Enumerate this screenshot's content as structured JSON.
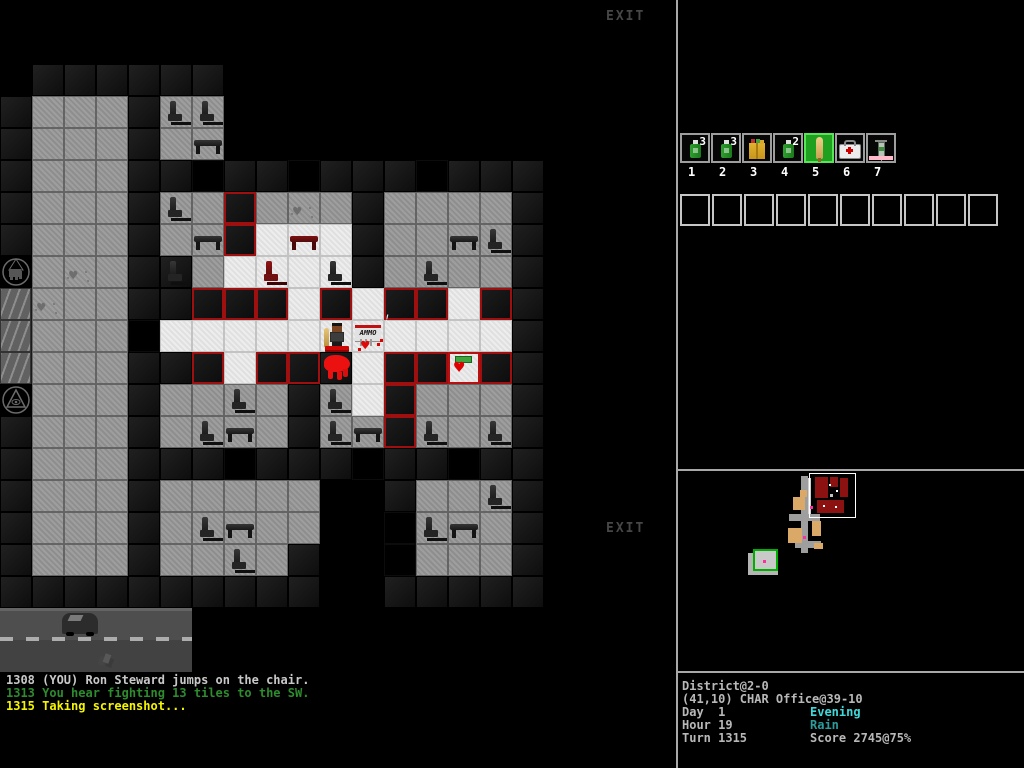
{
  "ui": {
    "exit_top": "EXIT",
    "exit_mid": "EXIT"
  },
  "character": {
    "title": "(YOU) Ron Steward, civilian"
  },
  "stats": {
    "rows": [
      {
        "label": "HP",
        "value": "12",
        "max": "15",
        "extra": "",
        "extra_color": "#ffffff",
        "fill": 0.8,
        "tick": null,
        "color": "#e60000"
      },
      {
        "label": "STA",
        "value": "33",
        "max": "35",
        "extra": "can run",
        "extra_color": "#22aa22",
        "fill": 0.94,
        "tick": 0.14,
        "color": "#1fa11f"
      },
      {
        "label": "FOO",
        "value": "919",
        "max": "1440",
        "extra": "6h",
        "extra_color": "#ffffff",
        "fill": 0.64,
        "tick": 0.51,
        "color": "#c0772c"
      },
      {
        "label": "SLP",
        "value": "1505",
        "max": "1800",
        "extra": "10h",
        "extra_color": "#ffffff",
        "fill": 0.84,
        "tick": 0.51,
        "color": "#2020dd"
      }
    ],
    "combat_lines": [
      "Melee  Atk 15   Dmg 10",
      "Ranged Atk 00   Dmg 00   Rng 0-0   Amo 0/0",
      "Def 12 Pro 0 Spd 1.00 FoV 5 Fol 0/0"
    ]
  },
  "inventory": {
    "header": "Inventory",
    "slots": [
      {
        "num": "1",
        "item": "bottle",
        "count": "3",
        "selected": false,
        "low_bar": false
      },
      {
        "num": "2",
        "item": "bottle",
        "count": "3",
        "selected": false,
        "low_bar": false
      },
      {
        "num": "3",
        "item": "bag",
        "count": "",
        "selected": false,
        "low_bar": false
      },
      {
        "num": "4",
        "item": "bottle",
        "count": "2",
        "selected": false,
        "low_bar": false
      },
      {
        "num": "5",
        "item": "bat",
        "count": "",
        "selected": true,
        "low_bar": false
      },
      {
        "num": "6",
        "item": "medkit",
        "count": "",
        "selected": false,
        "low_bar": false
      },
      {
        "num": "7",
        "item": "syringe",
        "count": "",
        "selected": false,
        "low_bar": true
      }
    ]
  },
  "ground": {
    "header": "Items on ground",
    "slot_count": 10
  },
  "skills": {
    "header": "Skills",
    "list": [
      "1-Agile",
      "1-Strong",
      "1-High Stamina"
    ]
  },
  "log": {
    "lines": [
      {
        "text": "1308 (YOU) Ron Steward jumps on the chair.",
        "color": "#c8c8c8"
      },
      {
        "text": "1313 You hear fighting 13 tiles to the SW.",
        "color": "#2e8b2e"
      },
      {
        "text": "1315 Taking screenshot...",
        "color": "#f5f500"
      }
    ]
  },
  "status": {
    "location": "District@2-0",
    "position": "(41,10) CHAR Office@39-10",
    "rows": [
      {
        "left": "Day  1",
        "right": "Evening",
        "right_color": "#3fd9d9"
      },
      {
        "left": "Hour 19",
        "right": "Rain",
        "right_color": "#2d9b9b"
      },
      {
        "left": "Turn 1315",
        "right": "Score 2745@75%",
        "right_color": "#b8b8b8"
      }
    ]
  },
  "map": {
    "ammo_label": "AMMO",
    "ammo_alert": "!!",
    "rows": [
      ".................",
      ".................",
      ".DDDDDD..........",
      "DGGGDGG..........",
      "DGGGDGG..........",
      "DGGGDDBDDBDDDBDDD",
      "DGGGDGGRGGGDGGGGD",
      "DGGGDGGRWWWDGGGGD",
      "1GGGDDGWWWWDGGGGD",
      "SGGGDDRRRWRWRRWRD",
      "SGGGBWWWWWWWWWWWD",
      "SGGGDDRWRRDWRRwRD",
      "2GGGDGGGGDGWRGGGD",
      "DGGGDGGGGDGGRGGGD",
      "DGGGDDDBDDDBDDBDD",
      "DGGGDGGGGG..DGGGD",
      "DGGGDGGGGG..BGGGD",
      "DGGGDGGGGD..BGGGD",
      "DDDDDDDDDD..DDDDD",
      "rrrrrr...........",
      "ssssss..........."
    ],
    "sprites": [
      {
        "type": "chair",
        "col": 5,
        "row": 3
      },
      {
        "type": "chair",
        "col": 6,
        "row": 3
      },
      {
        "type": "chair",
        "col": 5,
        "row": 6
      },
      {
        "type": "chair",
        "col": 5,
        "row": 8
      },
      {
        "type": "chair",
        "col": 15,
        "row": 7
      },
      {
        "type": "chair",
        "col": 13,
        "row": 8
      },
      {
        "type": "chair",
        "col": 10,
        "row": 8
      },
      {
        "type": "chair",
        "col": 7,
        "row": 12
      },
      {
        "type": "chair",
        "col": 10,
        "row": 12
      },
      {
        "type": "chair",
        "col": 6,
        "row": 13
      },
      {
        "type": "chair",
        "col": 10,
        "row": 13
      },
      {
        "type": "chair",
        "col": 13,
        "row": 13
      },
      {
        "type": "chair",
        "col": 15,
        "row": 13
      },
      {
        "type": "chair",
        "col": 15,
        "row": 15
      },
      {
        "type": "chair",
        "col": 6,
        "row": 16
      },
      {
        "type": "chair",
        "col": 13,
        "row": 16
      },
      {
        "type": "chair",
        "col": 7,
        "row": 17
      },
      {
        "type": "chair-red",
        "col": 8,
        "row": 8
      },
      {
        "type": "table",
        "col": 6,
        "row": 4
      },
      {
        "type": "table",
        "col": 6,
        "row": 7
      },
      {
        "type": "table",
        "col": 14,
        "row": 7
      },
      {
        "type": "table",
        "col": 7,
        "row": 13
      },
      {
        "type": "table",
        "col": 11,
        "row": 13
      },
      {
        "type": "table",
        "col": 7,
        "row": 16
      },
      {
        "type": "table",
        "col": 14,
        "row": 16
      },
      {
        "type": "table-red",
        "col": 9,
        "row": 7
      },
      {
        "type": "fluff",
        "col": 2,
        "row": 8
      },
      {
        "type": "fluff",
        "col": 1,
        "row": 9
      },
      {
        "type": "fluff",
        "col": 9,
        "row": 6
      },
      {
        "type": "blood",
        "col": 10,
        "row": 11
      },
      {
        "type": "heart-item",
        "col": 14,
        "row": 11
      },
      {
        "type": "player",
        "col": 10,
        "row": 10
      },
      {
        "type": "ammo-cart",
        "col": 11,
        "row": 10
      },
      {
        "type": "car",
        "x": 62,
        "y": 613
      },
      {
        "type": "debris",
        "x": 100,
        "y": 653
      },
      {
        "type": "road-dash",
        "x": 0,
        "y": 637
      }
    ]
  },
  "minimap": {
    "shapes": [
      {
        "x": 123,
        "y": 4,
        "w": 7,
        "h": 77,
        "fill": "#9e9e9e"
      },
      {
        "x": 111,
        "y": 42,
        "w": 31,
        "h": 7,
        "fill": "#9e9e9e"
      },
      {
        "x": 117,
        "y": 69,
        "w": 26,
        "h": 7,
        "fill": "#9e9e9e"
      },
      {
        "x": 130,
        "y": 6,
        "w": 3,
        "h": 36,
        "fill": "#cfcfcf"
      },
      {
        "x": 115,
        "y": 25,
        "w": 12,
        "h": 13,
        "fill": "#daa968"
      },
      {
        "x": 134,
        "y": 49,
        "w": 9,
        "h": 15,
        "fill": "#daa968"
      },
      {
        "x": 110,
        "y": 56,
        "w": 14,
        "h": 15,
        "fill": "#daa968"
      },
      {
        "x": 136,
        "y": 71,
        "w": 9,
        "h": 6,
        "fill": "#daa968"
      },
      {
        "x": 122,
        "y": 18,
        "w": 7,
        "h": 7,
        "fill": "#daa968"
      },
      {
        "x": 137,
        "y": 5,
        "w": 13,
        "h": 21,
        "fill": "#8c1212"
      },
      {
        "x": 152,
        "y": 5,
        "w": 8,
        "h": 10,
        "fill": "#8c1212"
      },
      {
        "x": 162,
        "y": 6,
        "w": 8,
        "h": 19,
        "fill": "#8c1212"
      },
      {
        "x": 139,
        "y": 28,
        "w": 27,
        "h": 13,
        "fill": "#8c1212"
      },
      {
        "x": 151,
        "y": 12,
        "w": 2,
        "h": 2,
        "fill": "#ffffff"
      },
      {
        "x": 158,
        "y": 18,
        "w": 2,
        "h": 2,
        "fill": "#ffffff"
      },
      {
        "x": 145,
        "y": 33,
        "w": 2,
        "h": 2,
        "fill": "#ffffff"
      },
      {
        "x": 157,
        "y": 34,
        "w": 2,
        "h": 2,
        "fill": "#ffffff"
      },
      {
        "x": 152,
        "y": 22,
        "w": 3,
        "h": 3,
        "fill": "#c0c0c0"
      },
      {
        "x": 132,
        "y": 34,
        "w": 3,
        "h": 3,
        "fill": "#ff2fa0"
      },
      {
        "x": 125,
        "y": 64,
        "w": 3,
        "h": 3,
        "fill": "#ff2fa0"
      },
      {
        "x": 70,
        "y": 94,
        "w": 30,
        "h": 9,
        "fill": "#b4b4b4"
      },
      {
        "x": 70,
        "y": 81,
        "w": 6,
        "h": 16,
        "fill": "#b4b4b4"
      },
      {
        "x": 75,
        "y": 77,
        "w": 25,
        "h": 22,
        "fill": "#c9c9c9",
        "border": "2px solid #00b000"
      },
      {
        "x": 85,
        "y": 88,
        "w": 3,
        "h": 3,
        "fill": "#ff2fa0"
      },
      {
        "x": 131,
        "y": 1,
        "w": 47,
        "h": 45,
        "fill": "none",
        "border": "1px solid #ffffff"
      }
    ]
  }
}
